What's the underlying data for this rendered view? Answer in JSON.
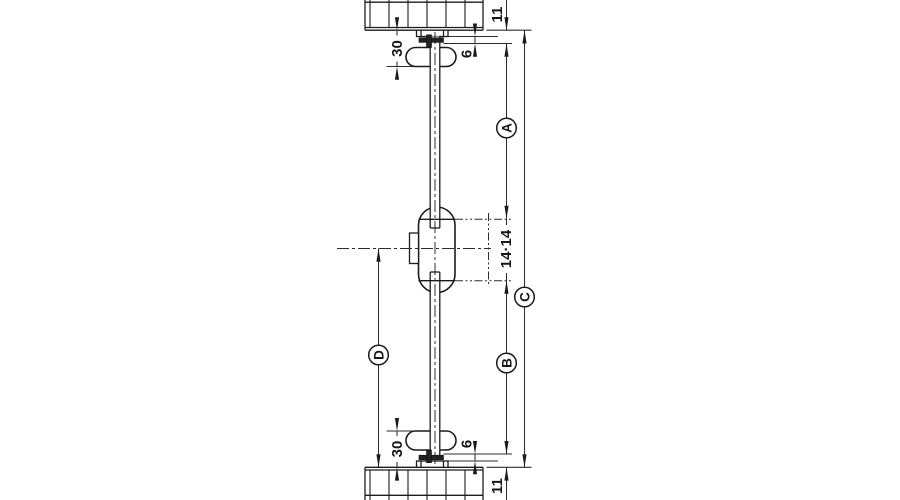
{
  "drawing": {
    "description": "Technical section drawing of a central locking rotary cylinder lock with connecting rod between top and bottom cabinet panels",
    "labels": {
      "dim_30_top": "30",
      "dim_6_top": "6",
      "dim_11_top": "11",
      "dim_a": "A",
      "dim_14_14": "14·14",
      "dim_c": "C",
      "dim_b": "B",
      "dim_d": "D",
      "dim_30_bottom": "30",
      "dim_6_bottom": "6",
      "dim_11_bottom": "11"
    },
    "colors": {
      "line": "#1c1c1c",
      "background": "#ffffff"
    }
  }
}
